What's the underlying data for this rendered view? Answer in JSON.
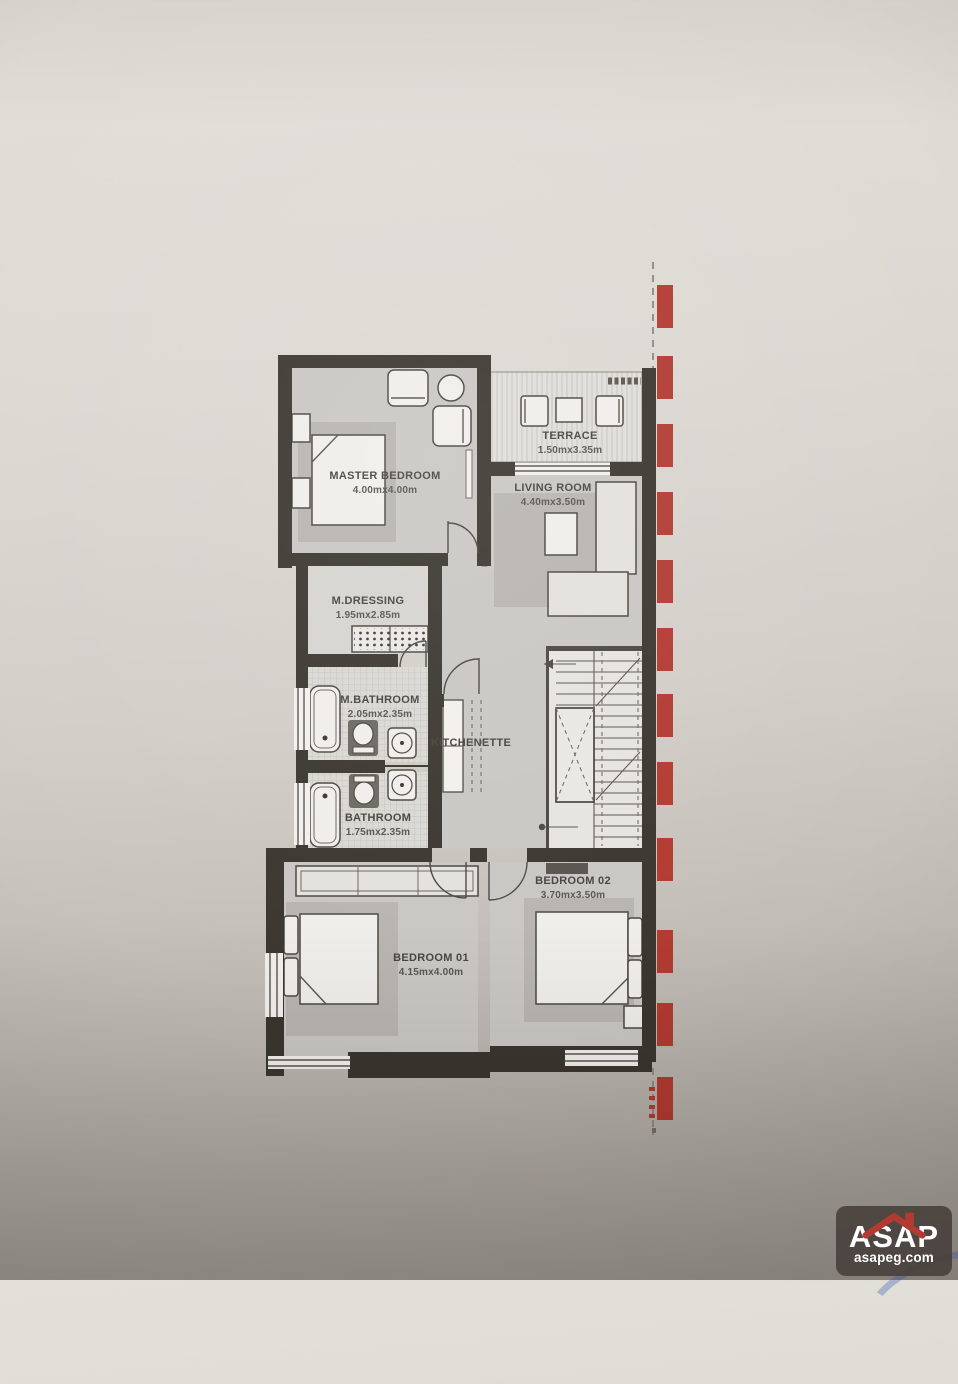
{
  "plan": {
    "rooms": {
      "master_bedroom": {
        "name": "MASTER BEDROOM",
        "dims": "4.00mx4.00m"
      },
      "terrace": {
        "name": "TERRACE",
        "dims": "1.50mx3.35m"
      },
      "living_room": {
        "name": "LIVING ROOM",
        "dims": "4.40mx3.50m"
      },
      "m_dressing": {
        "name": "M.DRESSING",
        "dims": "1.95mx2.85m"
      },
      "m_bathroom": {
        "name": "M.BATHROOM",
        "dims": "2.05mx2.35m"
      },
      "kitchenette": {
        "name": "KITCHENETTE"
      },
      "bathroom": {
        "name": "BATHROOM",
        "dims": "1.75mx2.35m"
      },
      "bedroom_01": {
        "name": "BEDROOM 01",
        "dims": "4.15mx4.00m"
      },
      "bedroom_02": {
        "name": "BEDROOM 02",
        "dims": "3.70mx3.50m"
      }
    }
  },
  "logo": {
    "brand": "ASAP",
    "site": "asapeg.com"
  },
  "colors": {
    "accent_red": "#b23a30",
    "wall_dark": "#3a362f",
    "ink": "#46443f",
    "room_gray": "#c9c7c3"
  }
}
